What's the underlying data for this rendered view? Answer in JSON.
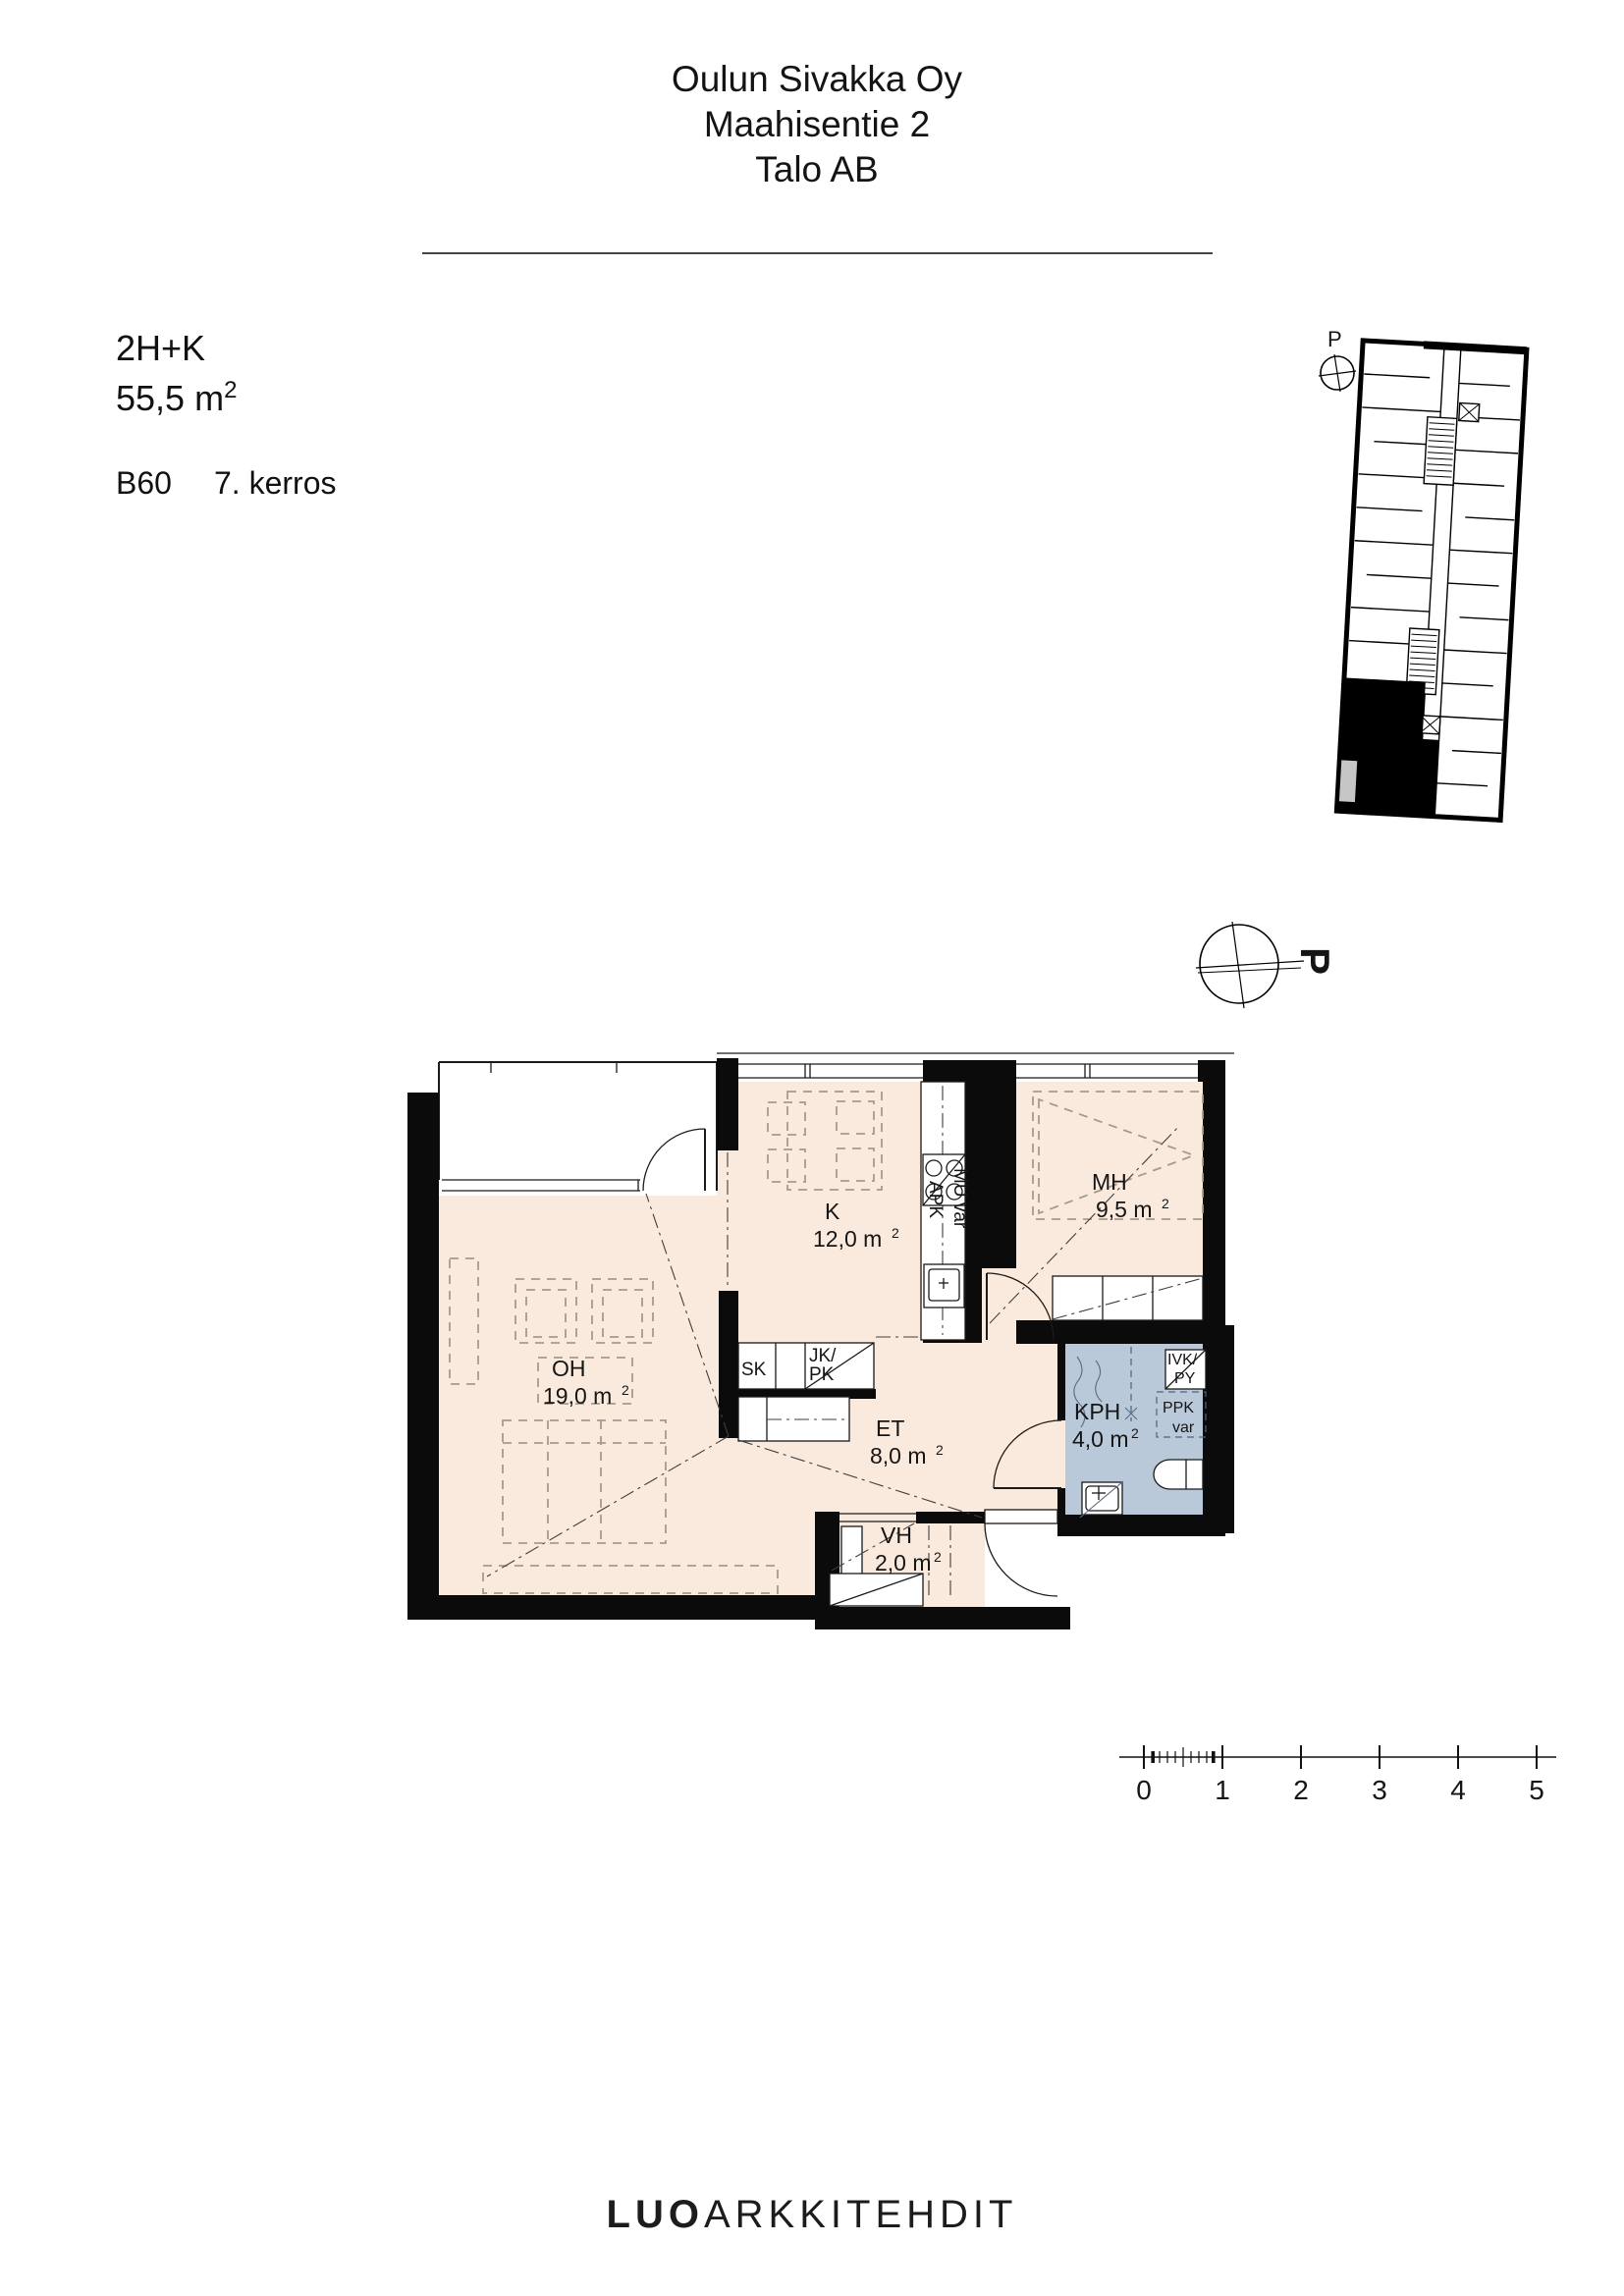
{
  "header": {
    "line1": "Oulun Sivakka Oy",
    "line2": "Maahisentie 2",
    "line3": "Talo AB"
  },
  "apartment": {
    "type": "2H+K",
    "area_value": "55,5 m",
    "area_sup": "2",
    "unit_id": "B60",
    "floor": "7. kerros"
  },
  "compass": {
    "north_label": "P"
  },
  "keyplan": {
    "north_label": "P"
  },
  "rooms": [
    {
      "id": "oh",
      "name": "OH",
      "area": "19,0 m",
      "sup": "2"
    },
    {
      "id": "k",
      "name": "K",
      "area": "12,0 m",
      "sup": "2"
    },
    {
      "id": "mh",
      "name": "MH",
      "area": "9,5 m",
      "sup": "2"
    },
    {
      "id": "et",
      "name": "ET",
      "area": "8,0 m",
      "sup": "2"
    },
    {
      "id": "kph",
      "name": "KPH",
      "area": "4,0 m",
      "sup": "2"
    },
    {
      "id": "vh",
      "name": "VH",
      "area": "2,0 m",
      "sup": "2"
    }
  ],
  "fixtures": {
    "sk": "SK",
    "jk": "JK/",
    "pk": "PK",
    "apk": "APK",
    "mu_var": "MU var",
    "ivk": "IVK/",
    "py": "PY",
    "ppk": "PPK",
    "var": "var"
  },
  "scalebar": {
    "labels": [
      "0",
      "1",
      "2",
      "3",
      "4",
      "5"
    ]
  },
  "footer": {
    "brand_bold": "LUO",
    "brand_light": "ARKKITEHDIT"
  },
  "colors": {
    "floor": "#faeadd",
    "wet_room": "#b9c9da",
    "wall": "#0b0b0b",
    "furniture_dash": "#a59a8c",
    "keyplan_gray": "#c6c6c6"
  }
}
